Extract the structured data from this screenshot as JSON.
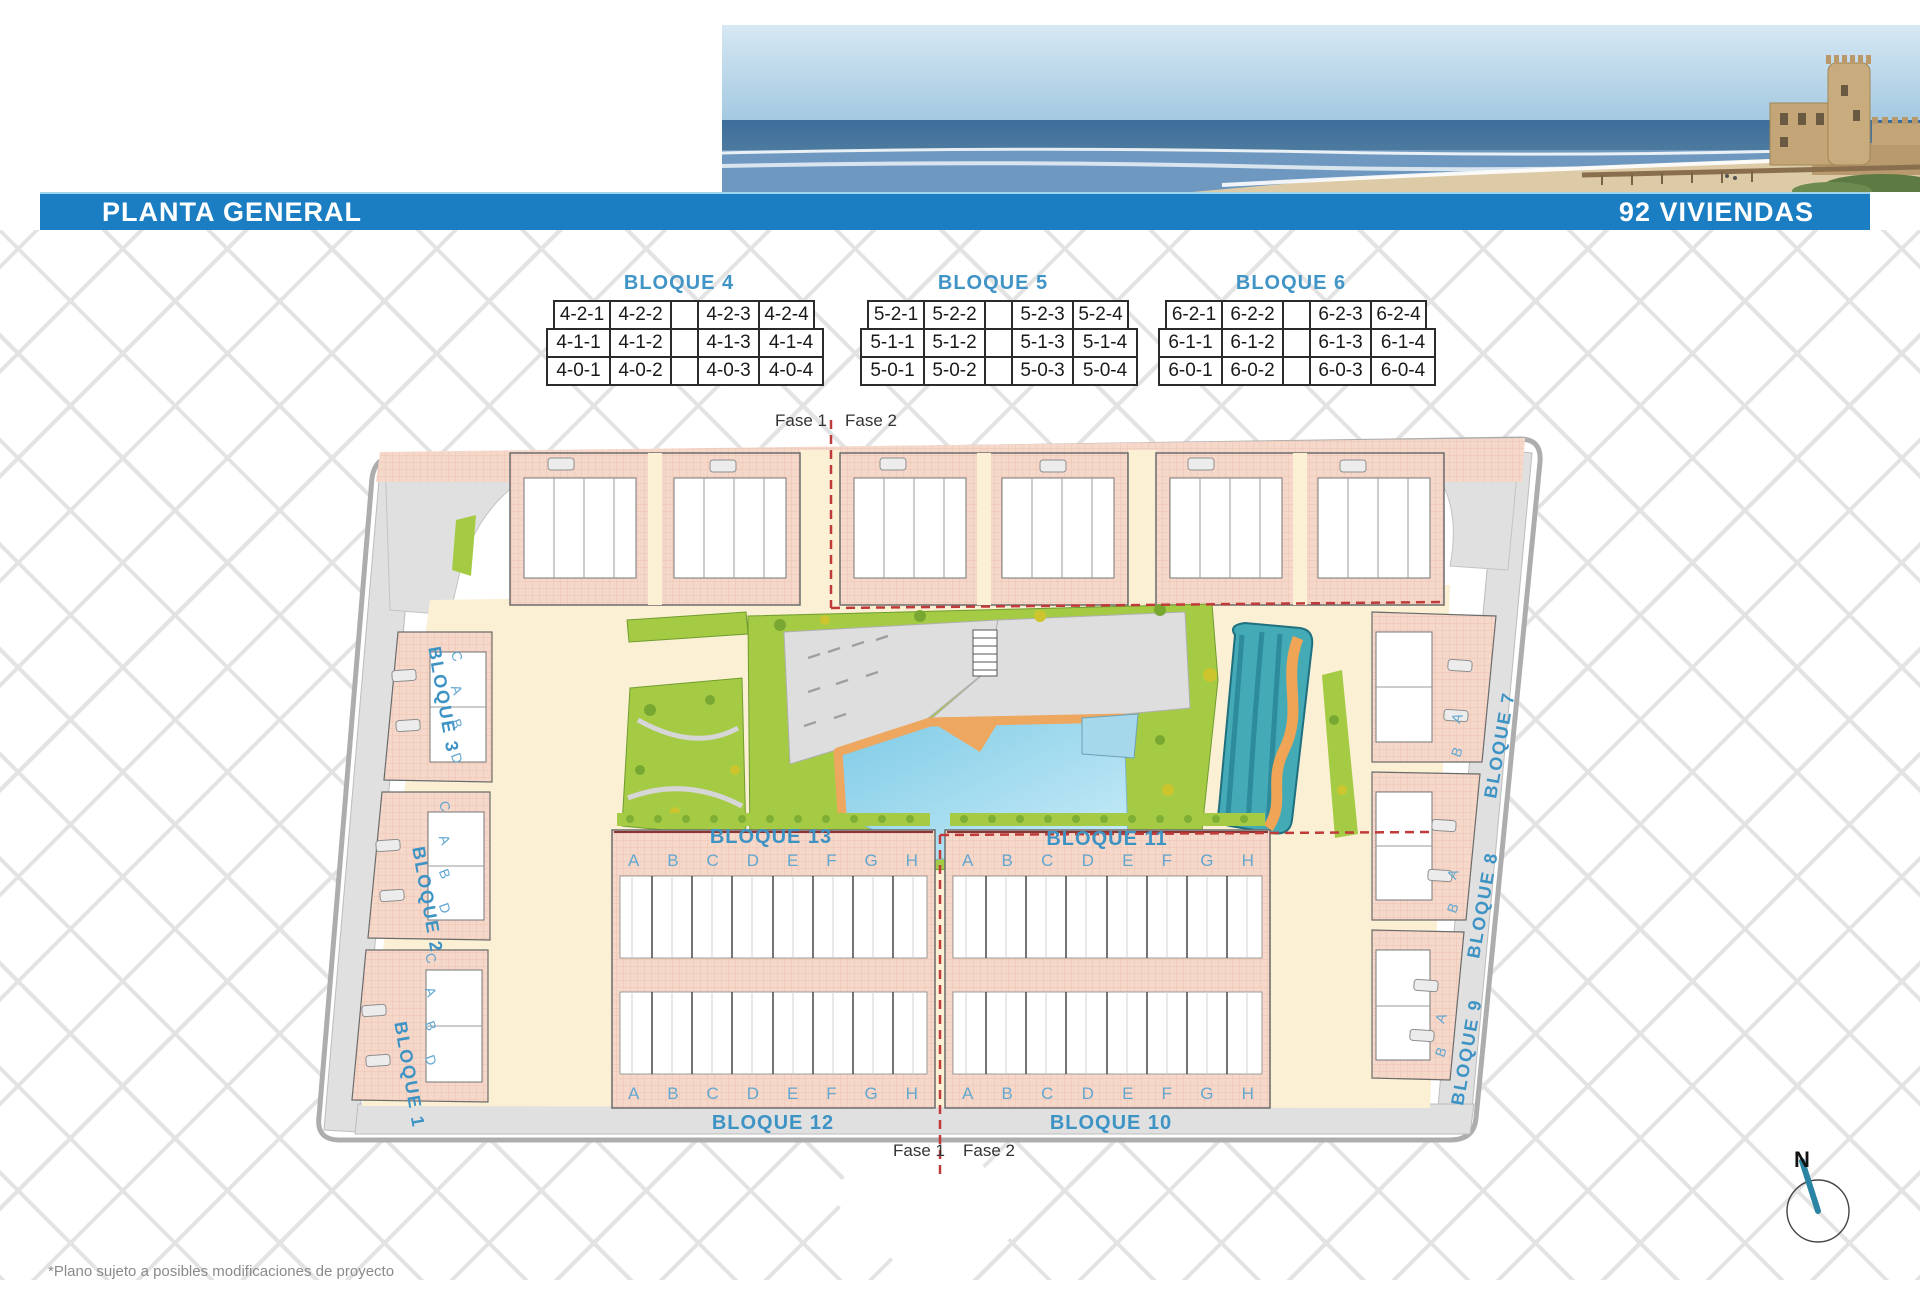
{
  "header": {
    "title": "PLANTA GENERAL",
    "subtitle": "92 VIVIENDAS"
  },
  "unit_tables": [
    {
      "title": "BLOQUE 4",
      "rows": [
        [
          "4-2-1",
          "4-2-2",
          "",
          "4-2-3",
          "4-2-4"
        ],
        [
          "4-1-1",
          "4-1-2",
          "",
          "4-1-3",
          "4-1-4"
        ],
        [
          "4-0-1",
          "4-0-2",
          "",
          "4-0-3",
          "4-0-4"
        ]
      ]
    },
    {
      "title": "BLOQUE 5",
      "rows": [
        [
          "5-2-1",
          "5-2-2",
          "",
          "5-2-3",
          "5-2-4"
        ],
        [
          "5-1-1",
          "5-1-2",
          "",
          "5-1-3",
          "5-1-4"
        ],
        [
          "5-0-1",
          "5-0-2",
          "",
          "5-0-3",
          "5-0-4"
        ]
      ]
    },
    {
      "title": "BLOQUE 6",
      "rows": [
        [
          "6-2-1",
          "6-2-2",
          "",
          "6-2-3",
          "6-2-4"
        ],
        [
          "6-1-1",
          "6-1-2",
          "",
          "6-1-3",
          "6-1-4"
        ],
        [
          "6-0-1",
          "6-0-2",
          "",
          "6-0-3",
          "6-0-4"
        ]
      ]
    }
  ],
  "site_plan": {
    "phase_top": {
      "left": "Fase 1",
      "right": "Fase 2"
    },
    "phase_bottom": {
      "left": "Fase 1",
      "right": "Fase 2"
    },
    "row_blocks": [
      {
        "label": "BLOQUE 13",
        "letters": [
          "A",
          "B",
          "C",
          "D",
          "E",
          "F",
          "G",
          "H"
        ]
      },
      {
        "label": "BLOQUE 11",
        "letters": [
          "A",
          "B",
          "C",
          "D",
          "E",
          "F",
          "G",
          "H"
        ]
      },
      {
        "label": "BLOQUE 12",
        "letters": [
          "A",
          "B",
          "C",
          "D",
          "E",
          "F",
          "G",
          "H"
        ]
      },
      {
        "label": "BLOQUE 10",
        "letters": [
          "A",
          "B",
          "C",
          "D",
          "E",
          "F",
          "G",
          "H"
        ]
      }
    ],
    "left_blocks": [
      {
        "label": "BLOQUE 3",
        "letters": [
          "C",
          "A",
          "B",
          "D"
        ]
      },
      {
        "label": "BLOQUE 2",
        "letters": [
          "C",
          "A",
          "B",
          "D"
        ]
      },
      {
        "label": "BLOQUE 1",
        "letters": [
          "C",
          "A",
          "B",
          "D"
        ]
      }
    ],
    "right_blocks": [
      {
        "label": "BLOQUE 7",
        "letters": [
          "A",
          "B"
        ]
      },
      {
        "label": "BLOQUE 8",
        "letters": [
          "A",
          "B"
        ]
      },
      {
        "label": "BLOQUE 9",
        "letters": [
          "A",
          "B"
        ]
      }
    ],
    "compass_label": "N"
  },
  "footnote": "*Plano sujeto a posibles modificaciones de proyecto",
  "colors": {
    "banner_blue": "#1b7ec2",
    "label_blue": "#3e93c5",
    "letter_blue": "#62a7d1",
    "building_pink": "#f6d8ca",
    "garden_green": "#a5cb45",
    "pool_blue": "#8fd2ea",
    "splash_teal": "#43aab6",
    "deck_orange": "#eda75f",
    "phase_red": "#c03a3a",
    "courtyard_cream": "#fbf0d4"
  }
}
